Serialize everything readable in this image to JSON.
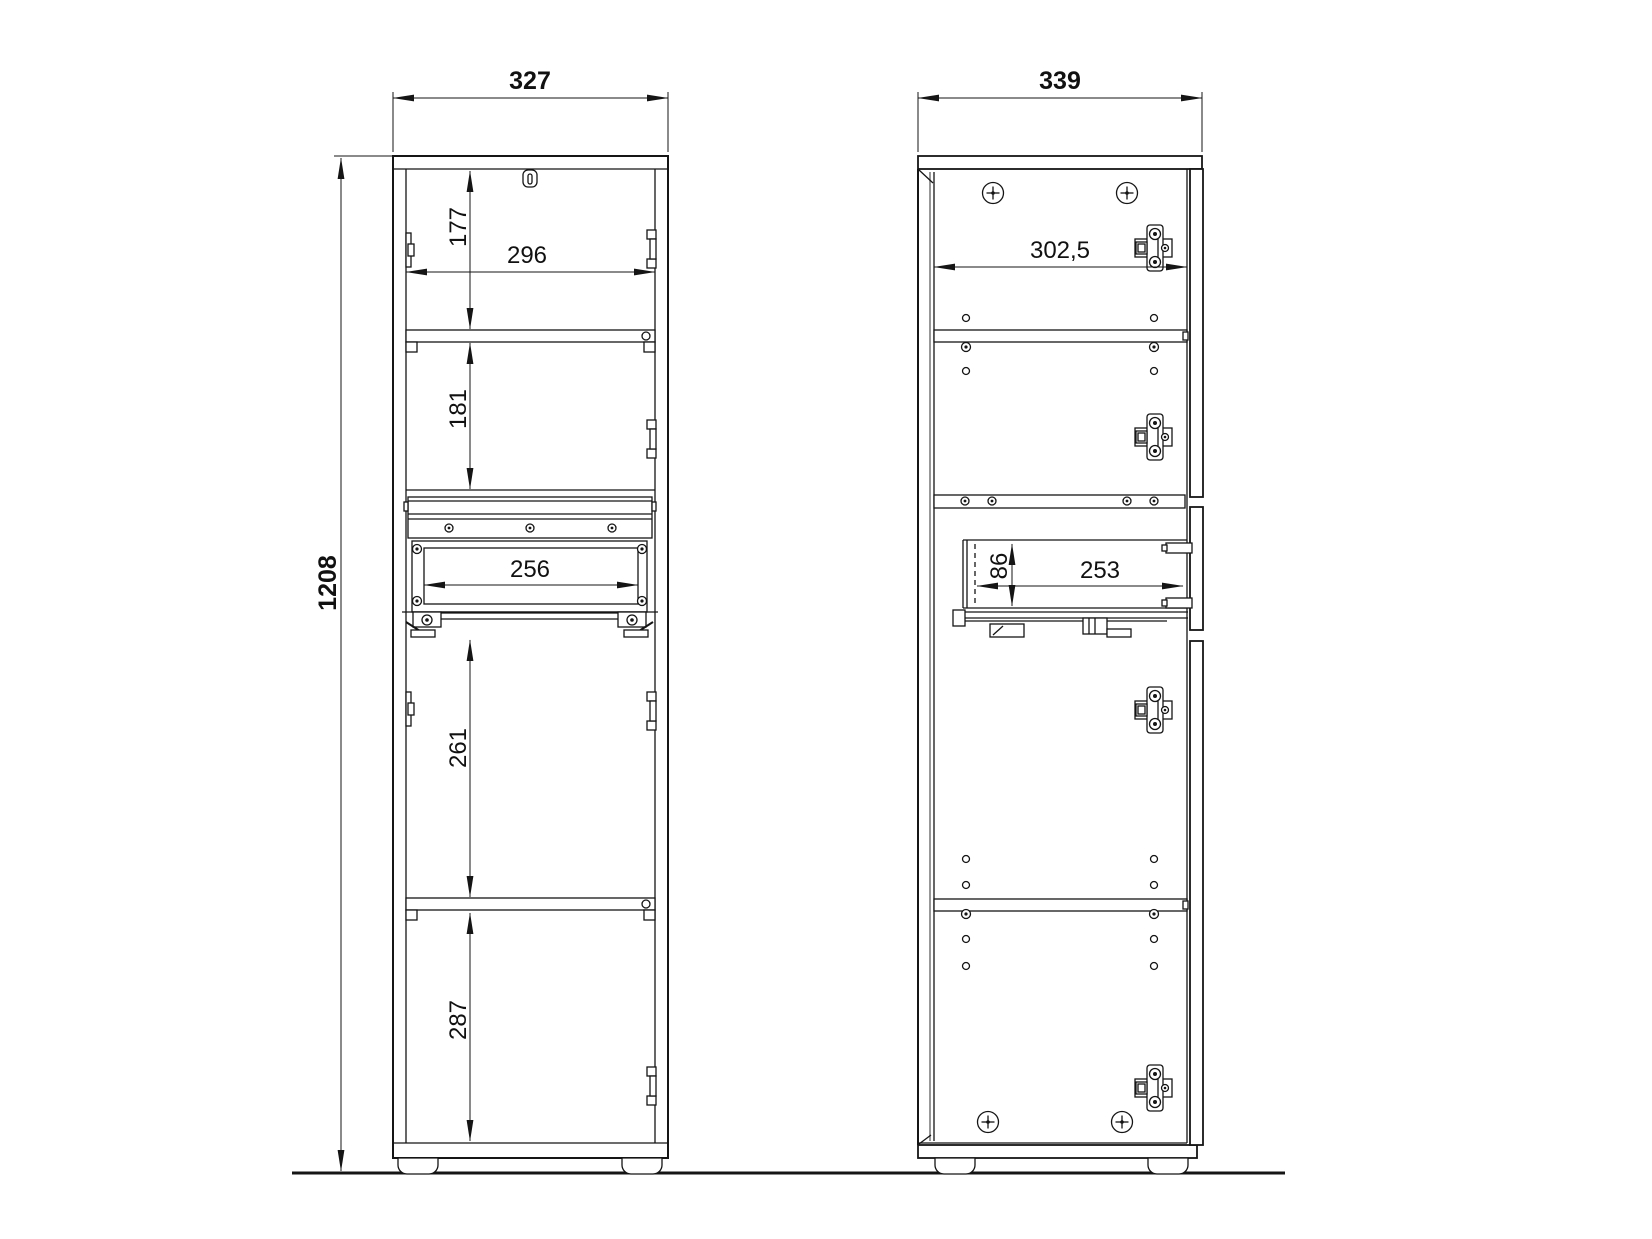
{
  "drawing": {
    "background": "#ffffff",
    "line_color": "#151515",
    "ground_line": true,
    "left_view": {
      "name": "cabinet-front-view",
      "dims": {
        "overall_width": "327",
        "overall_height": "1208",
        "top_section_height": "177",
        "inner_width": "296",
        "middle_section_height": "181",
        "drawer_inner_width": "256",
        "lower_section_height": "261",
        "bottom_section_height": "287"
      }
    },
    "right_view": {
      "name": "cabinet-side-view",
      "dims": {
        "overall_depth": "339",
        "inner_depth": "302,5",
        "drawer_inner_height": "86",
        "drawer_inner_depth": "253"
      }
    }
  }
}
